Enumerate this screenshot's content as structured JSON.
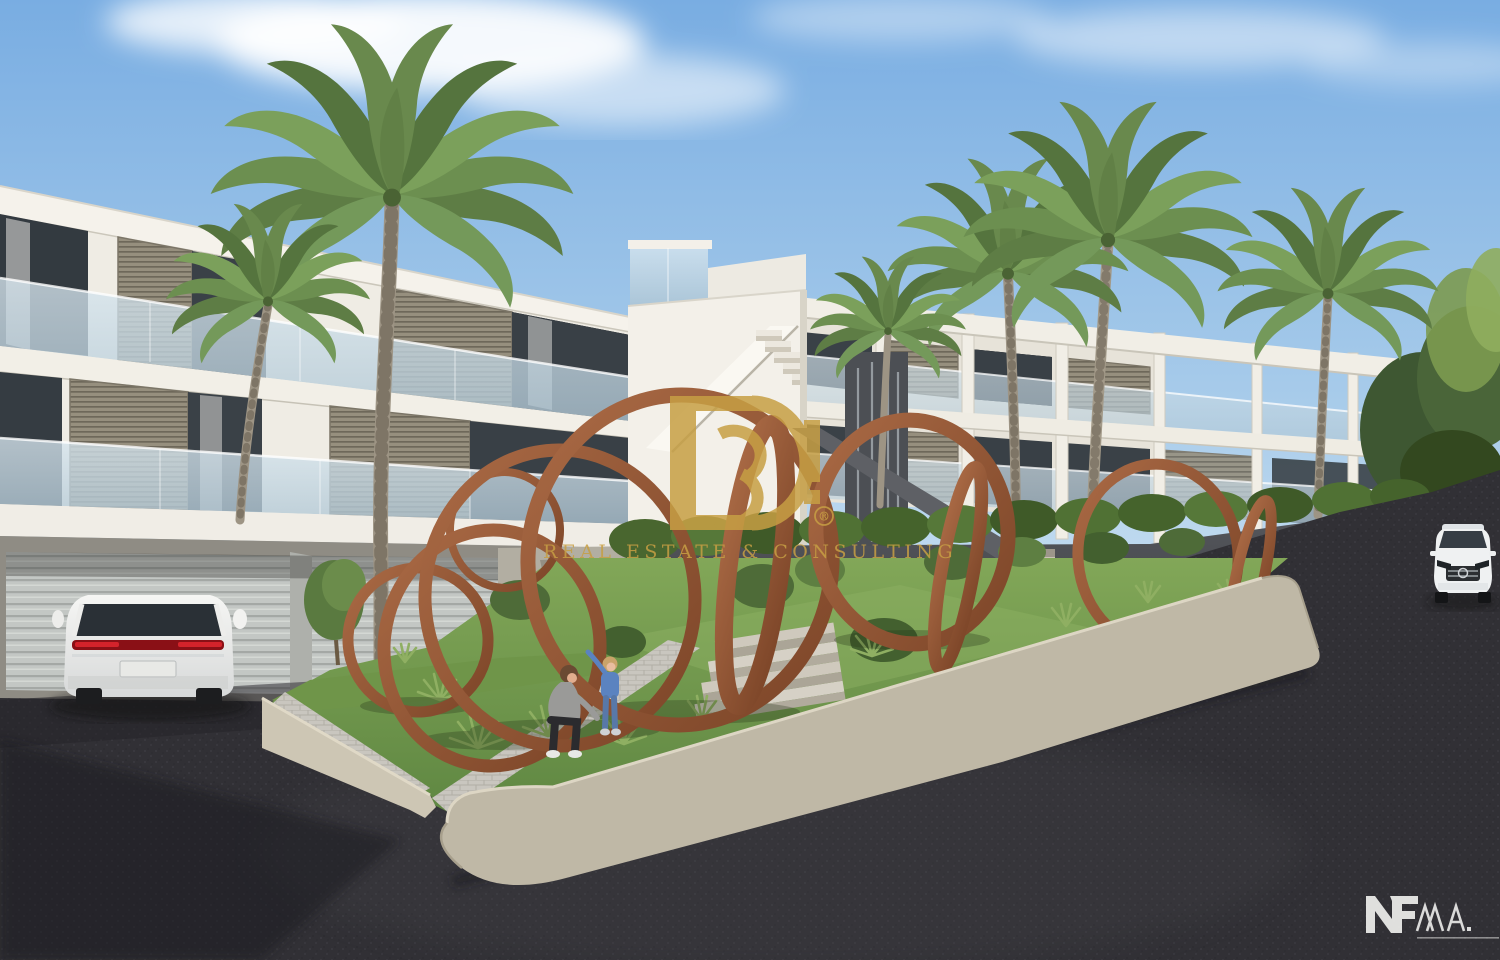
{
  "watermark": {
    "monogram": {
      "letter_d": "D",
      "digit": "3",
      "registered": "®"
    },
    "tagline": "REAL ESTATE & CONSULTING",
    "color": "#C79F44"
  },
  "corner_logos": {
    "nf": "NF",
    "ma": "MA."
  },
  "palette": {
    "sky_top": "#79ADE2",
    "sky_horizon": "#D8E9F5",
    "building_white": "#F0EDE6",
    "shutter_gray": "#8E8A7C",
    "glass_blue": "#C3D7E3",
    "corten_rust": "#9C5B3C",
    "grass_green": "#6F9549",
    "asphalt_dark": "#313035",
    "wall_beige": "#BFB8A6",
    "dark_wall": "#54565B",
    "garage_door_gray": "#C3C7C4"
  }
}
